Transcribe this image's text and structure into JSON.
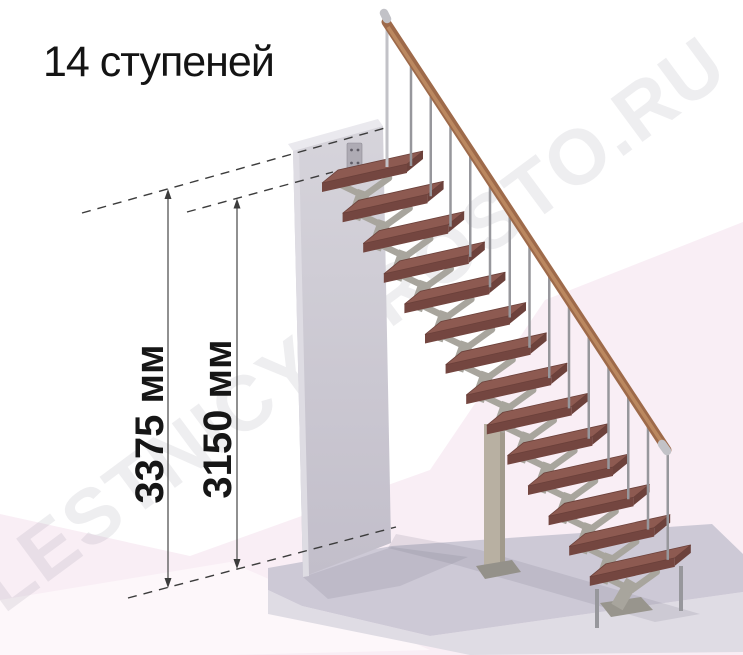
{
  "title": "14 ступеней",
  "watermark": "LESTNICY-PROSTO.RU",
  "dimensions": [
    {
      "label": "3375 мм"
    },
    {
      "label": "3150 мм"
    }
  ],
  "stairs": {
    "step_count": 14,
    "handrail": "wood",
    "treads": "wood"
  },
  "colors": {
    "tread_top": "#8d5a51",
    "tread_front": "#744640",
    "tread_side": "#6d423c",
    "tread_stroke": "#6b403a",
    "rail": "#9e6a4a",
    "rail_highlight": "#bf8c63",
    "metal_cap": "#c2c2c7",
    "baluster": "#97979c",
    "support": "#a8a59d",
    "support_dark": "#98958d",
    "wall_top_face": "#eae9ee",
    "wall_side": "#dedce3",
    "wall_grad_top": "#d6d4db",
    "wall_grad_bottom": "#c2beca",
    "bracket": "#aeabb4",
    "bracket_hole": "#5f5c66",
    "slab_top": "#cdc9d6",
    "slab_front": "#dfdce4",
    "shadow": "rgba(115,110,132,0.16)",
    "column": "#b8b0a2",
    "column_side": "#a19a8c",
    "column_base": "#94918a",
    "pink": "#f9eef5",
    "pink_light": "#fdf7fa",
    "dash": "#3c3c3c",
    "dim_line": "#555555",
    "watermark_fill": "rgba(90,88,108,0.10)"
  }
}
